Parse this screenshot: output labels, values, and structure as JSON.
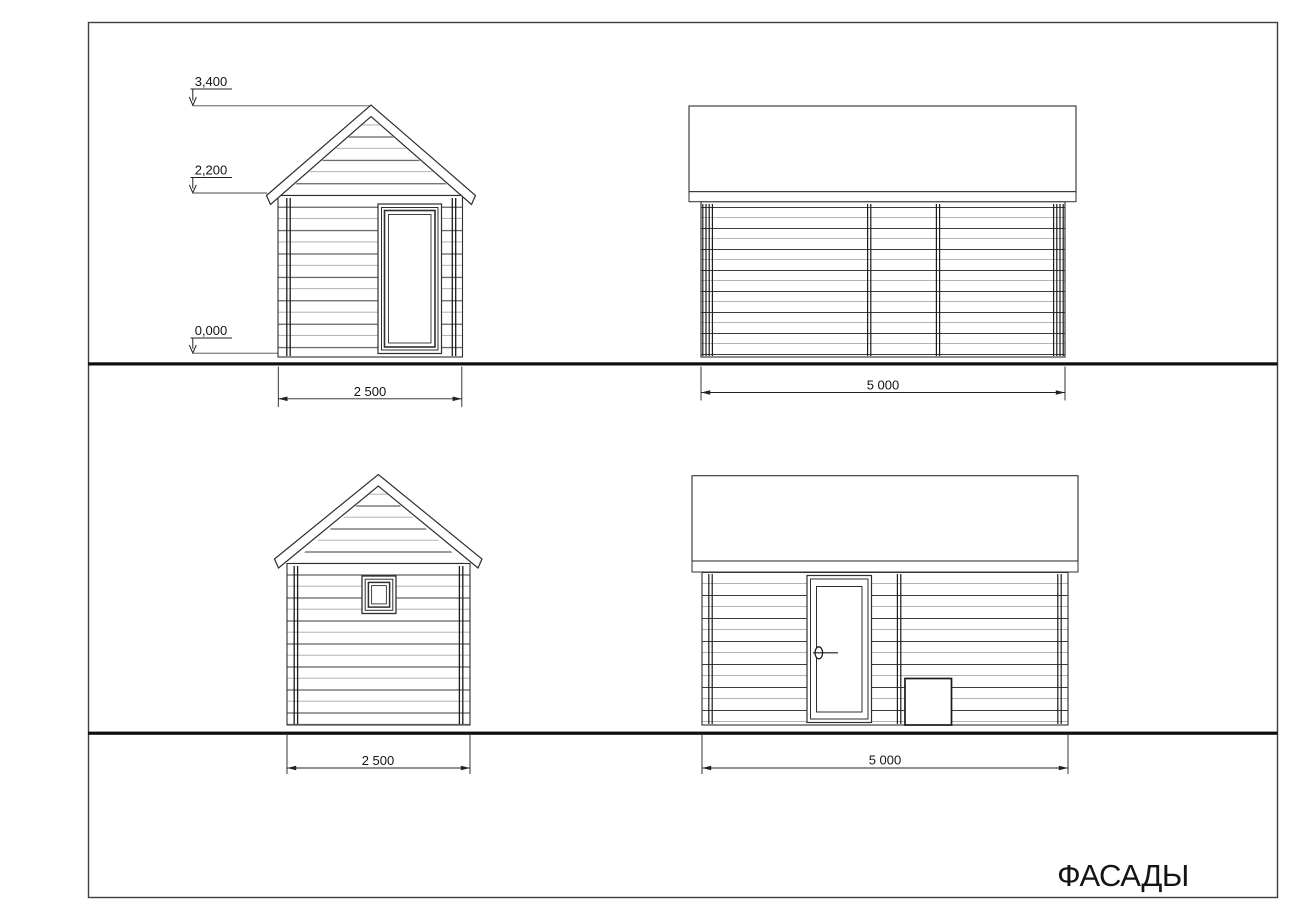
{
  "sheet": {
    "title": "ФАСАДЫ"
  },
  "front_elevation": {
    "level_marks": {
      "ridge": "3,400",
      "eaves": "2,200",
      "ground": "0,000"
    },
    "width_dimension": "2 500"
  },
  "right_side_elevation": {
    "length_dimension": "5 000"
  },
  "back_elevation": {
    "width_dimension": "2 500"
  },
  "left_side_elevation": {
    "length_dimension": "5 000"
  }
}
